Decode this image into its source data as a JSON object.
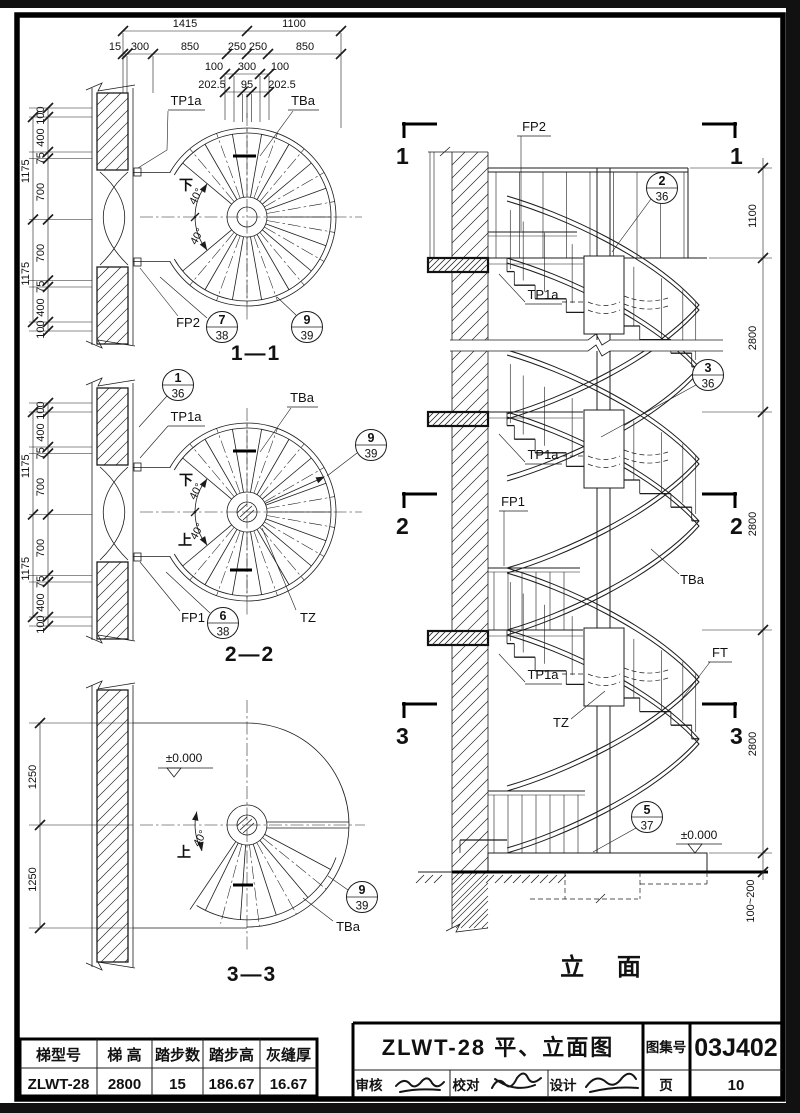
{
  "sheet": {
    "paper": "#ffffff",
    "ink": "#1c1c1c"
  },
  "dims": {
    "top_row1": [
      "1415",
      "1100"
    ],
    "top_row2": [
      "15",
      "300",
      "850",
      "250",
      "250",
      "850"
    ],
    "top_row3": [
      "100",
      "300",
      "100"
    ],
    "top_row4": [
      "202.5",
      "95",
      "202.5"
    ],
    "left_outer": [
      "1175",
      "1175"
    ],
    "left_inner": [
      "100",
      "400",
      "75",
      "700",
      "700",
      "75",
      "400",
      "100"
    ],
    "plan3_left": [
      "1250",
      "1250"
    ],
    "elev_right": [
      "1100",
      "2800",
      "2800",
      "2800",
      "100~200"
    ]
  },
  "plan1": {
    "title": "1—1",
    "tp1a": "TP1a",
    "tba": "TBa",
    "down": "下",
    "deg1": "40°",
    "deg2": "40°",
    "fp2": "FP2",
    "b1_top": "7",
    "b1_bot": "38",
    "b2_top": "9",
    "b2_bot": "39"
  },
  "plan2": {
    "title": "2—2",
    "b0_top": "1",
    "b0_bot": "36",
    "tp1a": "TP1a",
    "tba": "TBa",
    "down": "下",
    "up": "上",
    "deg1": "40°",
    "deg2": "40°",
    "fp1": "FP1",
    "b1_top": "6",
    "b1_bot": "38",
    "b2_top": "9",
    "b2_bot": "39",
    "tz": "TZ"
  },
  "plan3": {
    "title": "3—3",
    "level": "±0.000",
    "up": "上",
    "deg": "40°",
    "b_top": "9",
    "b_bot": "39",
    "tba": "TBa"
  },
  "elev": {
    "title": "立 面",
    "m1": "1",
    "m2": "2",
    "m3": "3",
    "fp2": "FP2",
    "fp1": "FP1",
    "tp1a_1": "TP1a",
    "tp1a_2": "TP1a",
    "tp1a_3": "TP1a",
    "tba": "TBa",
    "ft": "FT",
    "tz": "TZ",
    "level": "±0.000",
    "b1_top": "2",
    "b1_bot": "36",
    "b2_top": "3",
    "b2_bot": "36",
    "b3_top": "5",
    "b3_bot": "37"
  },
  "table": {
    "headers": [
      "梯型号",
      "梯  高",
      "踏步数",
      "踏步高",
      "灰缝厚"
    ],
    "values": [
      "ZLWT-28",
      "2800",
      "15",
      "186.67",
      "16.67"
    ]
  },
  "title_block": {
    "title": "ZLWT-28 平、立面图",
    "atlas_label": "图集号",
    "atlas_no": "03J402",
    "review": "审核",
    "proof": "校对",
    "design": "设计",
    "page_label": "页",
    "page_no": "10"
  }
}
